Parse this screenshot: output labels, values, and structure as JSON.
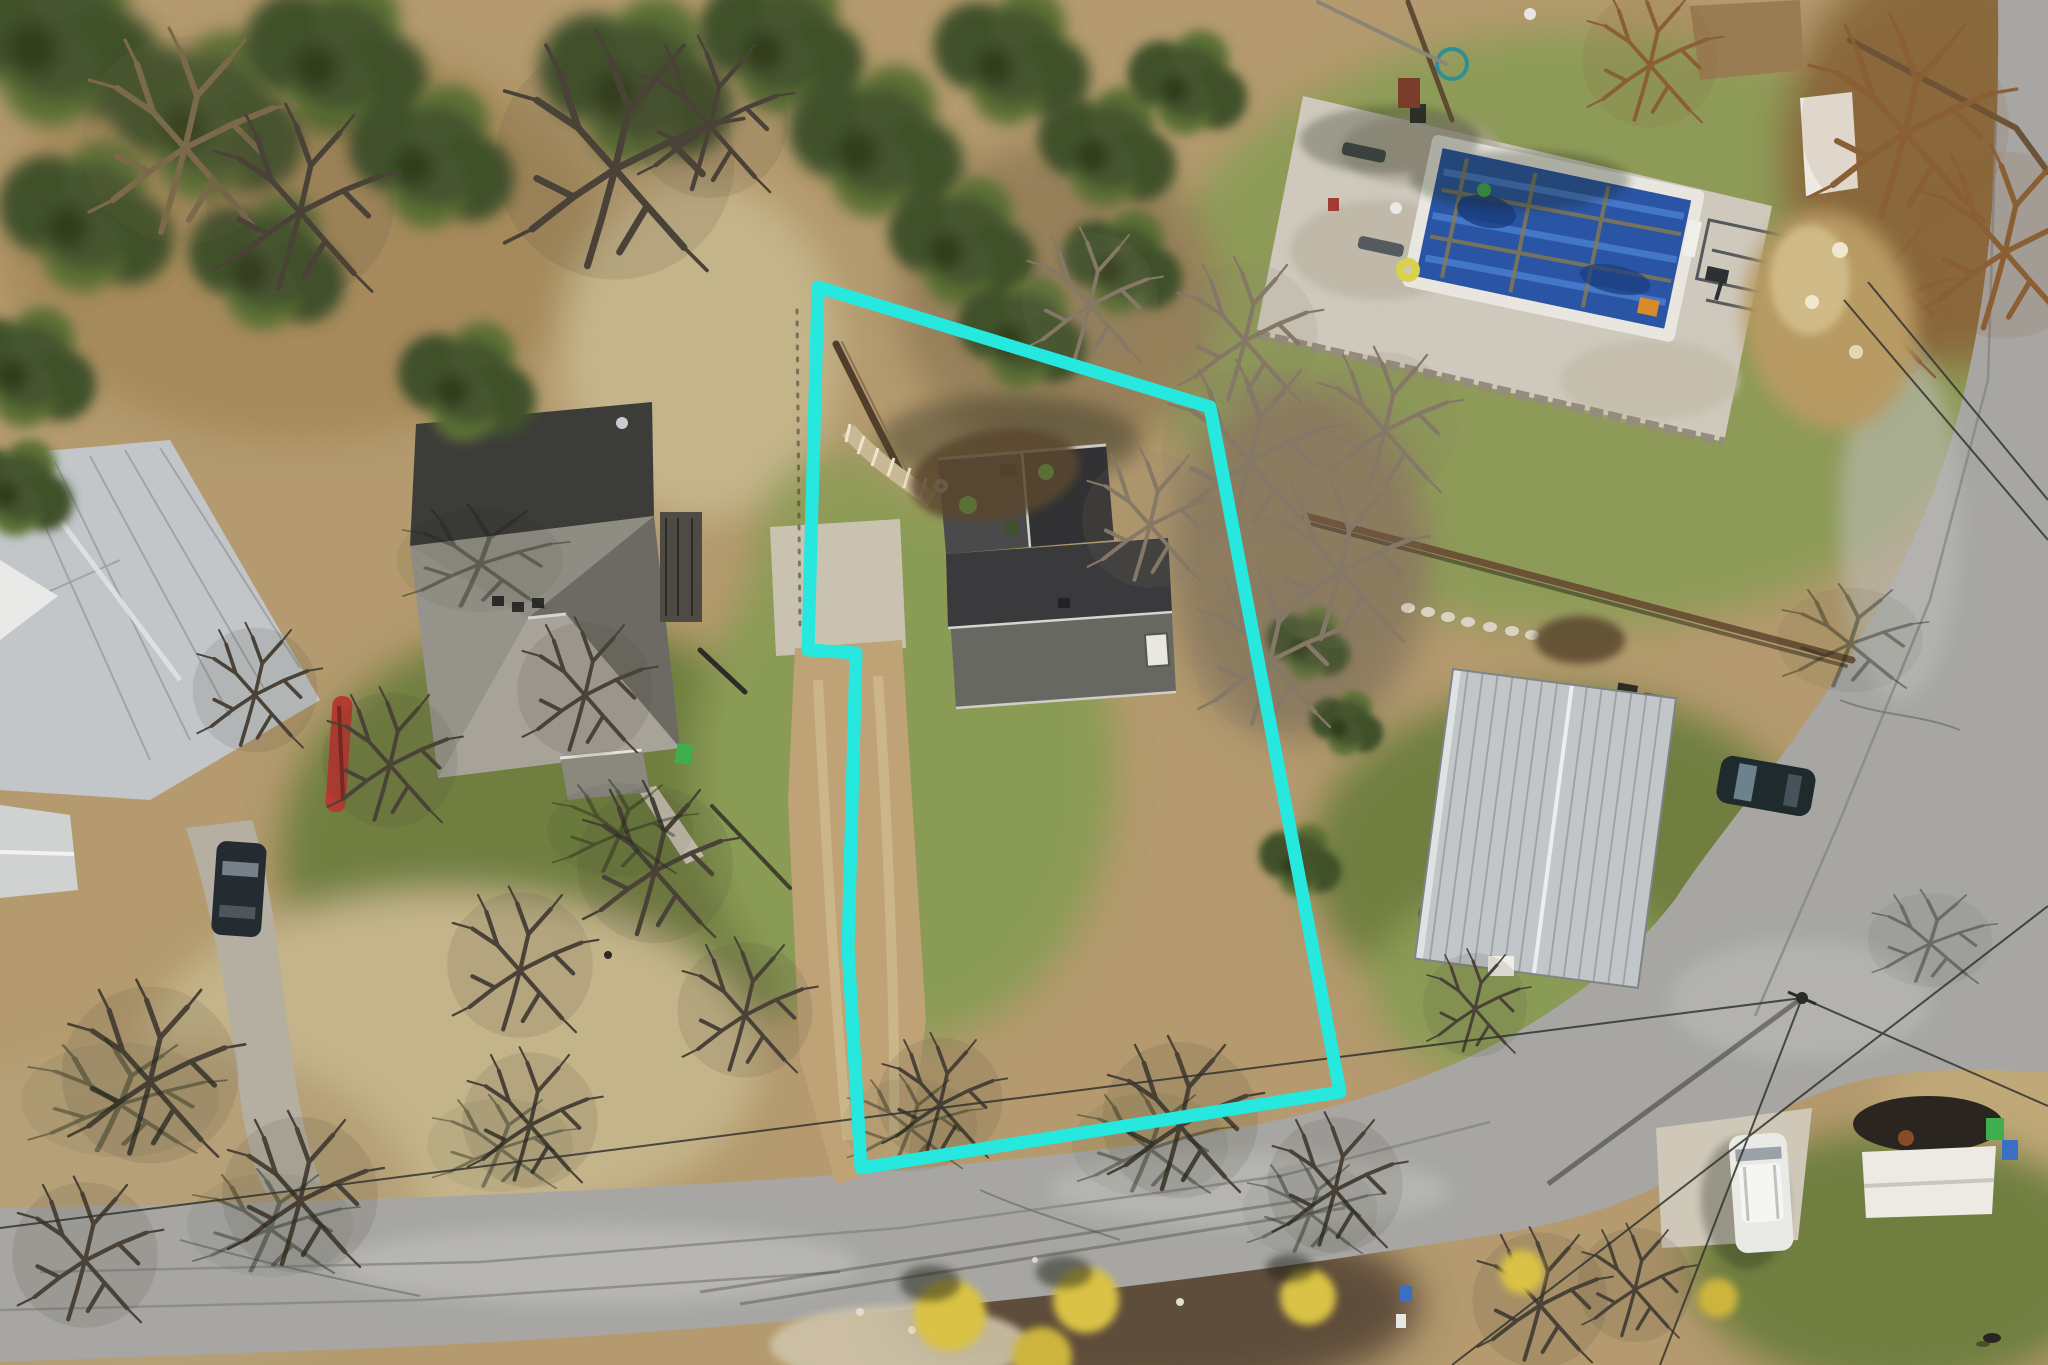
{
  "scene": {
    "type": "aerial-drone-photo",
    "annotation": "property-boundary-outline"
  },
  "boundary": {
    "points_attr": "818,287 1210,407 1340,1092 861,1168 848,948 856,653 808,650",
    "color": "#27e8de",
    "stroke_width": 13
  },
  "palette": {
    "boundary": "#27e8de",
    "ground": "#b49a6e",
    "ground_light": "#c9b386",
    "grass_green": "#8a9b54",
    "grass_olive": "#6f7f41",
    "grass_pale": "#c4b489",
    "verge_brown": "#5e4d3b",
    "road": "#a7a6a3",
    "road_worn": "#bbbab6",
    "road_seam": "#8b8a87",
    "concrete": "#cfc8b8",
    "dirt": "#bfa377",
    "pad": "#c9c2b0",
    "pine_dark": "#3f512c",
    "pine_mid": "#5c6f36",
    "branch": "#4a4237",
    "brush": "#857866",
    "orange_brush": "#8a5f33",
    "shadow": "#1c2417",
    "roof_dark": "#4a4a4c",
    "roof_darker": "#323234",
    "roof_ridge": "#d5d5cf",
    "hip_sun": "#a7a399",
    "hip_mid": "#8f8c83",
    "hip_shadow": "#3c3c38",
    "metal": "#c2c6c8",
    "metal_light": "#dfe2e3",
    "metal_seam": "#95999b",
    "pool_blue": "#2a55a4",
    "pool_blue_light": "#4f83d4",
    "pool_blue_dark": "#1a3c7e",
    "coping": "#e8e6df",
    "deck": "#cfc9bd",
    "canopy_white": "#eceae2",
    "kayak_red": "#b53a30",
    "bin_green": "#3fae4e",
    "bin_blue": "#3a6fc4",
    "car_white": "#e9e9e6",
    "car_dark": "#242b31",
    "wood_fence": "#6b5236",
    "mulch": "#5a462f",
    "bush_yellow": "#d9c244",
    "steps_tan": "#c9b896",
    "wall_stone": "#958c7b"
  }
}
